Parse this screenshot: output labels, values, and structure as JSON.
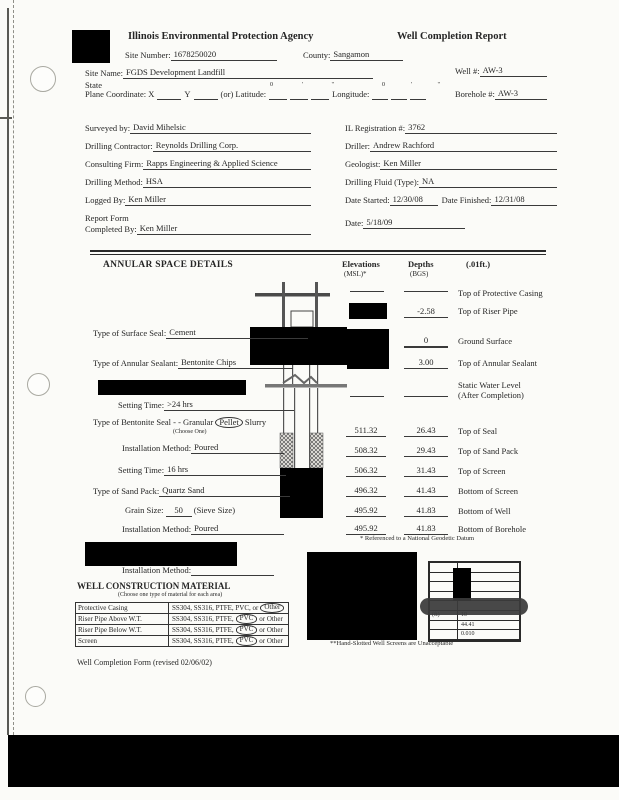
{
  "colors": {
    "redaction": "#000000",
    "paper": "#fbfbf8",
    "ink": "#262626"
  },
  "header": {
    "agency": "Illinois Environmental Protection Agency",
    "report_title": "Well Completion Report",
    "site_number_label": "Site Number:",
    "site_number": "1678250020",
    "county_label": "County:",
    "county": "Sangamon",
    "site_name_label": "Site Name:",
    "site_name": "FGDS Development Landfill",
    "well_label": "Well #:",
    "well": "AW-3",
    "borehole_label": "Borehole #:",
    "borehole": "AW-3",
    "state_label": "State",
    "plane_coordinate_label": "Plane Coordinate: X",
    "y_label": "Y",
    "latitude_label": "(or) Latitude:",
    "longitude_label": "Longitude:",
    "deg_mark": "0",
    "min_mark": "'",
    "sec_mark": "\""
  },
  "info": {
    "left": [
      {
        "label": "Surveyed by:",
        "value": "David Mihelsic"
      },
      {
        "label": "Drilling Contractor:",
        "value": "Reynolds Drilling Corp."
      },
      {
        "label": "Consulting Firm:",
        "value": "Rapps Engineering & Applied Science"
      },
      {
        "label": "Drilling Method:",
        "value": "HSA"
      },
      {
        "label": "Logged By:",
        "value": "Ken Miller"
      },
      {
        "label_line1": "Report Form",
        "label_line2": "Completed By:",
        "value": "Ken Miller"
      }
    ],
    "right": [
      {
        "label": "IL Registration #:",
        "value": "3762"
      },
      {
        "label": "Driller:",
        "value": "Andrew Rachford"
      },
      {
        "label": "Geologist:",
        "value": "Ken Miller"
      },
      {
        "label": "Drilling Fluid (Type):",
        "value": "NA"
      },
      {
        "label": "Date Started:",
        "value": "12/30/08",
        "label2": "Date Finished:",
        "value2": "12/31/08"
      },
      {
        "label": "Date:",
        "value": "5/18/09"
      }
    ]
  },
  "annular": {
    "title": "ANNULAR SPACE DETAILS",
    "col_elevations": "Elevations",
    "col_elevations_sub": "(MSL)*",
    "col_depths": "Depths",
    "col_depths_sub": "(BGS)",
    "col_unit": "(.01ft.)",
    "fields": {
      "surface_seal": {
        "label": "Type of Surface Seal:",
        "value": "Cement"
      },
      "annular_sealant": {
        "label": "Type of Annular Sealant:",
        "value": "Bentonite Chips"
      },
      "setting_time_1": {
        "label": "Setting Time:",
        "value": ">24 hrs"
      },
      "bentonite_seal": {
        "label": "Type of Bentonite Seal - - Granular",
        "circled": "Pellet",
        "after": "Slurry",
        "note": "(Choose One)"
      },
      "installation_1": {
        "label": "Installation Method:",
        "value": "Poured"
      },
      "setting_time_2": {
        "label": "Setting Time:",
        "value": "16 hrs"
      },
      "sand_pack": {
        "label": "Type of Sand Pack:",
        "value": "Quartz Sand"
      },
      "grain_size": {
        "label": "Grain Size:",
        "value": "50",
        "after": "(Sieve Size)"
      },
      "installation_2": {
        "label": "Installation Method:",
        "value": "Poured"
      },
      "installation_3": {
        "label": "Installation Method:",
        "value": ""
      }
    },
    "rows": [
      {
        "elev": "",
        "depth": "",
        "label": "Top of Protective Casing"
      },
      {
        "elev": "",
        "depth": "-2.58",
        "label": "Top of Riser Pipe"
      },
      {
        "elev": "",
        "depth": "0",
        "label": "Ground Surface"
      },
      {
        "elev": "",
        "depth": "3.00",
        "label": "Top of Annular Sealant"
      },
      {
        "elev": "",
        "depth": "",
        "label": "Static Water Level",
        "label2": "(After Completion)"
      },
      {
        "elev": "511.32",
        "depth": "26.43",
        "label": "Top of Seal"
      },
      {
        "elev": "508.32",
        "depth": "29.43",
        "label": "Top of Sand Pack"
      },
      {
        "elev": "506.32",
        "depth": "31.43",
        "label": "Top of Screen"
      },
      {
        "elev": "496.32",
        "depth": "41.43",
        "label": "Bottom of Screen"
      },
      {
        "elev": "495.92",
        "depth": "41.83",
        "label": "Bottom of Well"
      },
      {
        "elev": "495.92",
        "depth": "41.83",
        "label": "Bottom of Borehole"
      }
    ],
    "footnote": "* Referenced to a National Geodetic Datum"
  },
  "construction": {
    "title": "WELL CONSTRUCTION MATERIAL",
    "subtitle": "(Choose one type of material for each area)",
    "rows": [
      {
        "area": "Protective Casing",
        "opt_prefix": "SS304, SS316, PTFE, PVC, or",
        "opt_circled": "Other",
        "opt_suffix": ""
      },
      {
        "area": "Riser Pipe Above W.T.",
        "opt_prefix": "SS304, SS316, PTFE,",
        "opt_circled": "PVC",
        "opt_suffix": "or Other"
      },
      {
        "area": "Riser Pipe Below W.T.",
        "opt_prefix": "SS304, SS316, PTFE,",
        "opt_circled": "PVC",
        "opt_suffix": "or Other"
      },
      {
        "area": "Screen",
        "opt_prefix": "SS304, SS316, PTFE,",
        "opt_circled": "PVC",
        "opt_suffix": "or Other"
      }
    ]
  },
  "screen_table": {
    "partial_label": "(ft)",
    "row_values": [
      "10",
      "44.41",
      "0.010"
    ],
    "footnote": "**Hand-Slotted Well Screens are Unacceptable"
  },
  "footer": {
    "form_revision": "Well Completion Form (revised 02/06/02)"
  }
}
